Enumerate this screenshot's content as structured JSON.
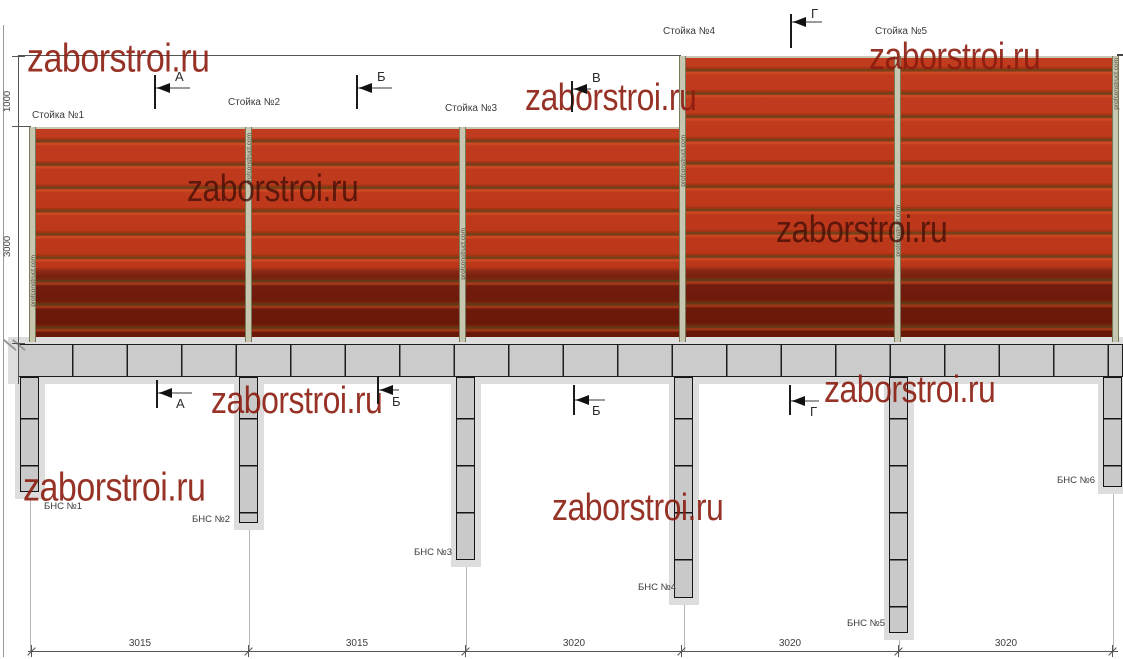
{
  "watermark": {
    "text": "zaborstroi.ru"
  },
  "brand": {
    "post_watermark": "profconstruct.com"
  },
  "posts": {
    "labels": [
      "Стойка №1",
      "Стойка №2",
      "Стойка №3",
      "Стойка №4",
      "Стойка №5"
    ]
  },
  "piles": {
    "labels": [
      "БНС №1",
      "БНС №2",
      "БНС №3",
      "БНС №4",
      "БНС №5",
      "БНС №6"
    ]
  },
  "markers": {
    "top": [
      "А",
      "Б",
      "В",
      "Г"
    ],
    "bottom": [
      "А",
      "Б",
      "Б",
      "Г"
    ]
  },
  "dims": {
    "vertical": [
      "1000",
      "3000"
    ],
    "horizontal": [
      "3015",
      "3015",
      "3020",
      "3020",
      "3020"
    ]
  },
  "colors": {
    "panel_red": "#c13b1e",
    "panel_dark_band": "#6e1a0c",
    "beam_gray": "#cbcbcb",
    "post_gray": "#c7c6b1",
    "watermark_red": "#8c1c0f"
  }
}
